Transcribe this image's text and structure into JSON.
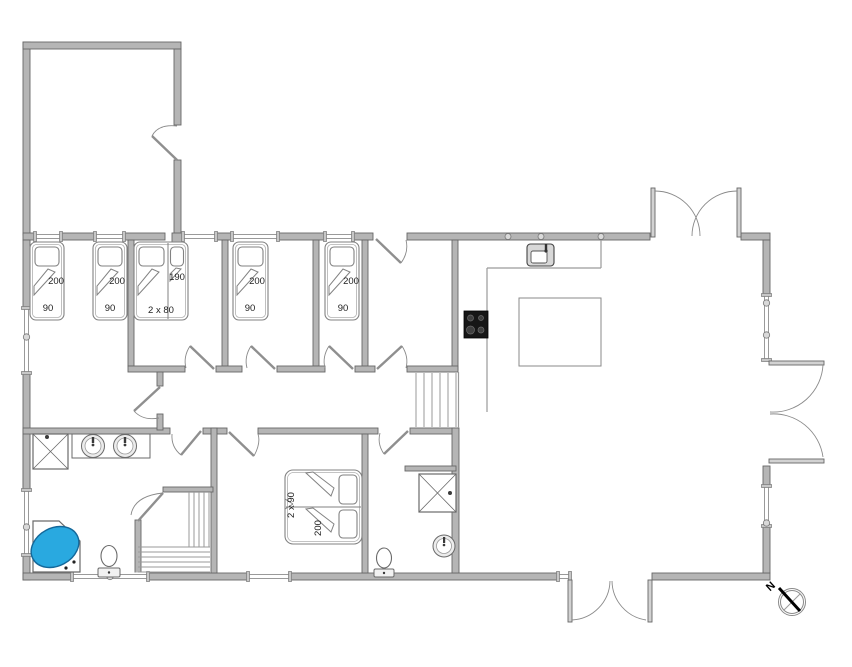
{
  "colors": {
    "wall_fill": "#b5b5b5",
    "wall_stroke": "#666666",
    "fixture_stroke": "#6a6a6a",
    "thin_line": "#9a9a9a",
    "door_arc": "#8a8a8a",
    "bed_stroke": "#828282",
    "tub_blue": "#29a9e0",
    "tub_blue_stroke": "#14689a",
    "stove_black": "#161616",
    "label_color": "#222222"
  },
  "compass": {
    "label": "N",
    "x": 773,
    "y": 589,
    "rot": -42,
    "cx": 792,
    "cy": 602,
    "r_outer": 13.5,
    "r_inner": 11.5
  },
  "labels": [
    {
      "text": "200",
      "x": 56,
      "y": 284,
      "rot": 0
    },
    {
      "text": "90",
      "x": 48,
      "y": 311,
      "rot": 0
    },
    {
      "text": "200",
      "x": 117,
      "y": 284,
      "rot": 0
    },
    {
      "text": "90",
      "x": 110,
      "y": 311,
      "rot": 0
    },
    {
      "text": "190",
      "x": 177,
      "y": 280,
      "rot": 0
    },
    {
      "text": "2 x 80",
      "x": 161,
      "y": 313,
      "rot": 0
    },
    {
      "text": "200",
      "x": 257,
      "y": 284,
      "rot": 0
    },
    {
      "text": "90",
      "x": 250,
      "y": 311,
      "rot": 0
    },
    {
      "text": "200",
      "x": 351,
      "y": 284,
      "rot": 0
    },
    {
      "text": "90",
      "x": 343,
      "y": 311,
      "rot": 0
    },
    {
      "text": "2 x 90",
      "x": 294,
      "y": 505,
      "rot": -90
    },
    {
      "text": "200",
      "x": 321,
      "y": 528,
      "rot": -90
    }
  ],
  "plan": {
    "walls": [
      [
        23,
        42,
        7,
        193
      ],
      [
        23,
        42,
        158,
        7
      ],
      [
        174,
        49,
        7,
        76
      ],
      [
        174,
        160,
        7,
        80
      ],
      [
        23,
        233,
        12,
        7
      ],
      [
        61,
        233,
        34,
        7
      ],
      [
        124,
        233,
        41,
        7
      ],
      [
        172,
        233,
        11,
        10
      ],
      [
        216,
        233,
        16,
        7
      ],
      [
        278,
        233,
        47,
        7
      ],
      [
        353,
        233,
        20,
        7
      ],
      [
        407,
        233,
        243,
        7
      ],
      [
        741,
        233,
        29,
        7
      ],
      [
        23,
        240,
        7,
        68
      ],
      [
        23,
        373,
        7,
        117
      ],
      [
        23,
        430,
        7,
        60
      ],
      [
        23,
        555,
        7,
        25
      ],
      [
        23,
        573,
        49,
        7
      ],
      [
        148,
        573,
        100,
        7
      ],
      [
        290,
        573,
        268,
        7
      ],
      [
        652,
        573,
        118,
        7
      ],
      [
        763,
        240,
        7,
        55
      ],
      [
        763,
        466,
        7,
        20
      ],
      [
        763,
        526,
        7,
        47
      ],
      [
        128,
        240,
        6,
        126
      ],
      [
        222,
        240,
        6,
        126
      ],
      [
        313,
        240,
        6,
        126
      ],
      [
        362,
        240,
        6,
        126
      ],
      [
        452,
        240,
        6,
        130
      ],
      [
        128,
        366,
        57,
        6
      ],
      [
        216,
        366,
        26,
        6
      ],
      [
        277,
        366,
        48,
        6
      ],
      [
        355,
        366,
        20,
        6
      ],
      [
        407,
        366,
        51,
        6
      ],
      [
        23,
        428,
        147,
        6
      ],
      [
        203,
        428,
        24,
        6
      ],
      [
        258,
        428,
        120,
        6
      ],
      [
        410,
        428,
        48,
        6
      ],
      [
        135,
        520,
        6,
        53
      ],
      [
        211,
        428,
        6,
        145
      ],
      [
        362,
        434,
        6,
        139
      ],
      [
        452,
        428,
        7,
        145
      ],
      [
        163,
        487,
        50,
        5
      ],
      [
        405,
        466,
        51,
        5
      ],
      [
        157,
        372,
        6,
        14
      ],
      [
        157,
        414,
        6,
        16
      ]
    ],
    "door_panels": [
      [
        651,
        188,
        4,
        49
      ],
      [
        737,
        188,
        4,
        49
      ],
      [
        769,
        361,
        55,
        4
      ],
      [
        769,
        459,
        55,
        4
      ],
      [
        568,
        580,
        4,
        42
      ],
      [
        648,
        580,
        4,
        42
      ]
    ],
    "french_arcs": [
      "M 655 191 A 45 45 0 0 1 700 236",
      "M 737 191 A 45 45 0 0 0 692 236",
      "M 823 365 A 50 50 0 0 1 770 412",
      "M 823 457 A 50 50 0 0 0 770 414",
      "M 572 620 A 40 40 0 0 0 610 581",
      "M 646 620 A 40 40 0 0 1 612 581"
    ],
    "doors": [
      {
        "panel": [
          177,
          160,
          152,
          136
        ],
        "arc": "M 152 136 Q 158 124 177 126"
      },
      {
        "panel": [
          376,
          239,
          401,
          263
        ],
        "arc": "M 401 263 Q 409 252 406 240"
      },
      {
        "panel": [
          214,
          369,
          190,
          346
        ],
        "arc": "M 190 346 Q 183 357 186 368"
      },
      {
        "panel": [
          275,
          369,
          251,
          346
        ],
        "arc": "M 251 346 Q 244 357 247 368"
      },
      {
        "panel": [
          353,
          369,
          329,
          346
        ],
        "arc": "M 329 346 Q 322 357 325 368"
      },
      {
        "panel": [
          377,
          369,
          402,
          346
        ],
        "arc": "M 402 346 Q 409 357 406 368"
      },
      {
        "panel": [
          160,
          387,
          134,
          411
        ],
        "arc": "M 134 411 Q 143 421 159 418"
      },
      {
        "panel": [
          201,
          431,
          181,
          455
        ],
        "arc": "M 181 455 Q 171 447 172 434"
      },
      {
        "panel": [
          229,
          432,
          254,
          456
        ],
        "arc": "M 254 456 Q 261 443 258 434"
      },
      {
        "panel": [
          408,
          431,
          384,
          454
        ],
        "arc": "M 384 454 Q 377 444 380 433"
      },
      {
        "panel": [
          138,
          521,
          163,
          493
        ],
        "arc": "M 163 493 Q 134 496 131 515"
      }
    ],
    "windows": [
      {
        "o": "h",
        "x": 35,
        "y": 233,
        "len": 26,
        "m": []
      },
      {
        "o": "h",
        "x": 95,
        "y": 233,
        "len": 29,
        "m": []
      },
      {
        "o": "h",
        "x": 183,
        "y": 233,
        "len": 33,
        "m": []
      },
      {
        "o": "h",
        "x": 232,
        "y": 233,
        "len": 46,
        "m": []
      },
      {
        "o": "h",
        "x": 325,
        "y": 233,
        "len": 28,
        "m": []
      },
      {
        "o": "v",
        "x": 23,
        "y": 308,
        "len": 65,
        "m": [
          337
        ]
      },
      {
        "o": "v",
        "x": 23,
        "y": 490,
        "len": 65,
        "m": [
          527
        ]
      },
      {
        "o": "h",
        "x": 72,
        "y": 573,
        "len": 76,
        "m": [
          110
        ]
      },
      {
        "o": "h",
        "x": 248,
        "y": 573,
        "len": 42,
        "m": []
      },
      {
        "o": "h",
        "x": 558,
        "y": 573,
        "len": 12,
        "m": []
      },
      {
        "o": "v",
        "x": 763,
        "y": 295,
        "len": 65,
        "m": [
          303,
          335
        ]
      },
      {
        "o": "v",
        "x": 763,
        "y": 486,
        "len": 40,
        "m": [
          523
        ]
      }
    ],
    "wall_markers": [
      [
        508,
        236.5
      ],
      [
        541,
        236.5
      ],
      [
        601,
        236.5
      ]
    ],
    "thin_lines": [
      [
        601,
        240,
        601,
        268
      ],
      [
        487,
        268,
        601,
        268
      ],
      [
        487,
        268,
        487,
        412
      ],
      [
        458.5,
        372,
        458.5,
        428
      ]
    ],
    "island": [
      519,
      298,
      82,
      68
    ],
    "stairs_upper": {
      "x_list": [
        416,
        424,
        432,
        440,
        448,
        456
      ],
      "y1": 373,
      "y2": 427
    },
    "stairs_lower": {
      "v_lines": [
        189,
        194,
        199,
        204,
        209
      ],
      "v_y1": 492,
      "v_y2": 547,
      "h_lines": [
        547,
        552,
        557,
        562,
        567,
        572
      ],
      "h_x1": 138,
      "h_x2": 210
    },
    "beds": [
      {
        "rrects": [
          [
            30,
            242,
            34,
            78,
            6
          ],
          [
            32.5,
            244.5,
            29,
            73,
            4
          ],
          [
            35,
            247,
            24,
            19,
            4
          ]
        ],
        "lines": [],
        "polys": [
          "34,295 55,272 48,269 34,286"
        ]
      },
      {
        "rrects": [
          [
            93,
            242,
            34,
            78,
            6
          ],
          [
            95.5,
            244.5,
            29,
            73,
            4
          ],
          [
            98,
            247,
            24,
            19,
            4
          ]
        ],
        "lines": [],
        "polys": [
          "97,295 118,272 111,269 97,286"
        ]
      },
      {
        "rrects": [
          [
            134,
            242,
            54,
            78,
            6
          ],
          [
            136.5,
            244.5,
            49,
            73,
            4
          ],
          [
            139,
            247,
            25,
            19,
            4
          ],
          [
            170.5,
            247,
            13,
            19,
            4
          ]
        ],
        "lines": [
          [
            168,
            243,
            168,
            319
          ]
        ],
        "polys": [
          "138,295 159,272 152,269 138,286",
          "170,281 181,269 176,268 170,274"
        ]
      },
      {
        "rrects": [
          [
            233,
            242,
            35,
            78,
            6
          ],
          [
            235.5,
            244.5,
            30,
            73,
            4
          ],
          [
            238,
            247,
            25,
            19,
            4
          ]
        ],
        "lines": [],
        "polys": [
          "237,295 258,272 251,269 237,286"
        ]
      },
      {
        "rrects": [
          [
            325,
            242,
            34,
            78,
            6
          ],
          [
            327.5,
            244.5,
            29,
            73,
            4
          ],
          [
            330,
            247,
            24,
            19,
            4
          ]
        ],
        "lines": [],
        "polys": [
          "329,295 350,272 343,269 329,286"
        ]
      },
      {
        "rrects": [
          [
            285,
            470,
            77,
            74,
            8
          ],
          [
            287.5,
            472.5,
            72,
            69,
            6
          ],
          [
            339,
            475,
            18,
            29,
            4
          ],
          [
            339,
            510,
            18,
            28,
            4
          ]
        ],
        "lines": [
          [
            286,
            507,
            361,
            507
          ],
          [
            285,
            499,
            293,
            504
          ],
          [
            293,
            504,
            285,
            509
          ]
        ],
        "polys": [
          "306,473 331,496 334,488 313,472",
          "306,509 331,532 334,524 313,508"
        ]
      }
    ],
    "fixtures": {
      "showers": [
        [
          33,
          434,
          35,
          35
        ],
        [
          419,
          474,
          37,
          38
        ]
      ],
      "shower_dots": [
        [
          47,
          437
        ],
        [
          450,
          493
        ]
      ],
      "vanity": [
        72,
        434,
        78,
        24
      ],
      "vanity_sinks": [
        [
          93,
          446
        ],
        [
          125,
          446
        ]
      ],
      "wc_basin": {
        "cx": 444,
        "cy": 546,
        "r1": 11,
        "r2": 7.5
      },
      "toilets": [
        {
          "bx": 109,
          "by": 556,
          "rx": 8,
          "ry": 10.5,
          "tank": [
            98,
            568,
            22,
            9
          ]
        },
        {
          "bx": 384,
          "by": 558,
          "rx": 7.5,
          "ry": 10,
          "tank": [
            374,
            569,
            20,
            8
          ]
        }
      ],
      "tub": {
        "poly": "33,521 59,521 80,541 80,572 33,572",
        "ellipse": [
          55,
          547,
          25,
          19,
          -28
        ],
        "dots": [
          [
            74,
            562
          ],
          [
            66,
            568
          ]
        ]
      },
      "kitchen_sink": {
        "outer": [
          527,
          244,
          27,
          22
        ],
        "inner": [
          531,
          251,
          16,
          12
        ],
        "tap": [
          546,
          249
        ]
      },
      "stove": {
        "rect": [
          464,
          311,
          24,
          27
        ],
        "burners": [
          [
            470.5,
            318,
            3
          ],
          [
            481,
            318,
            2.5
          ],
          [
            470.5,
            330,
            4
          ],
          [
            481,
            330,
            3
          ]
        ]
      }
    }
  }
}
